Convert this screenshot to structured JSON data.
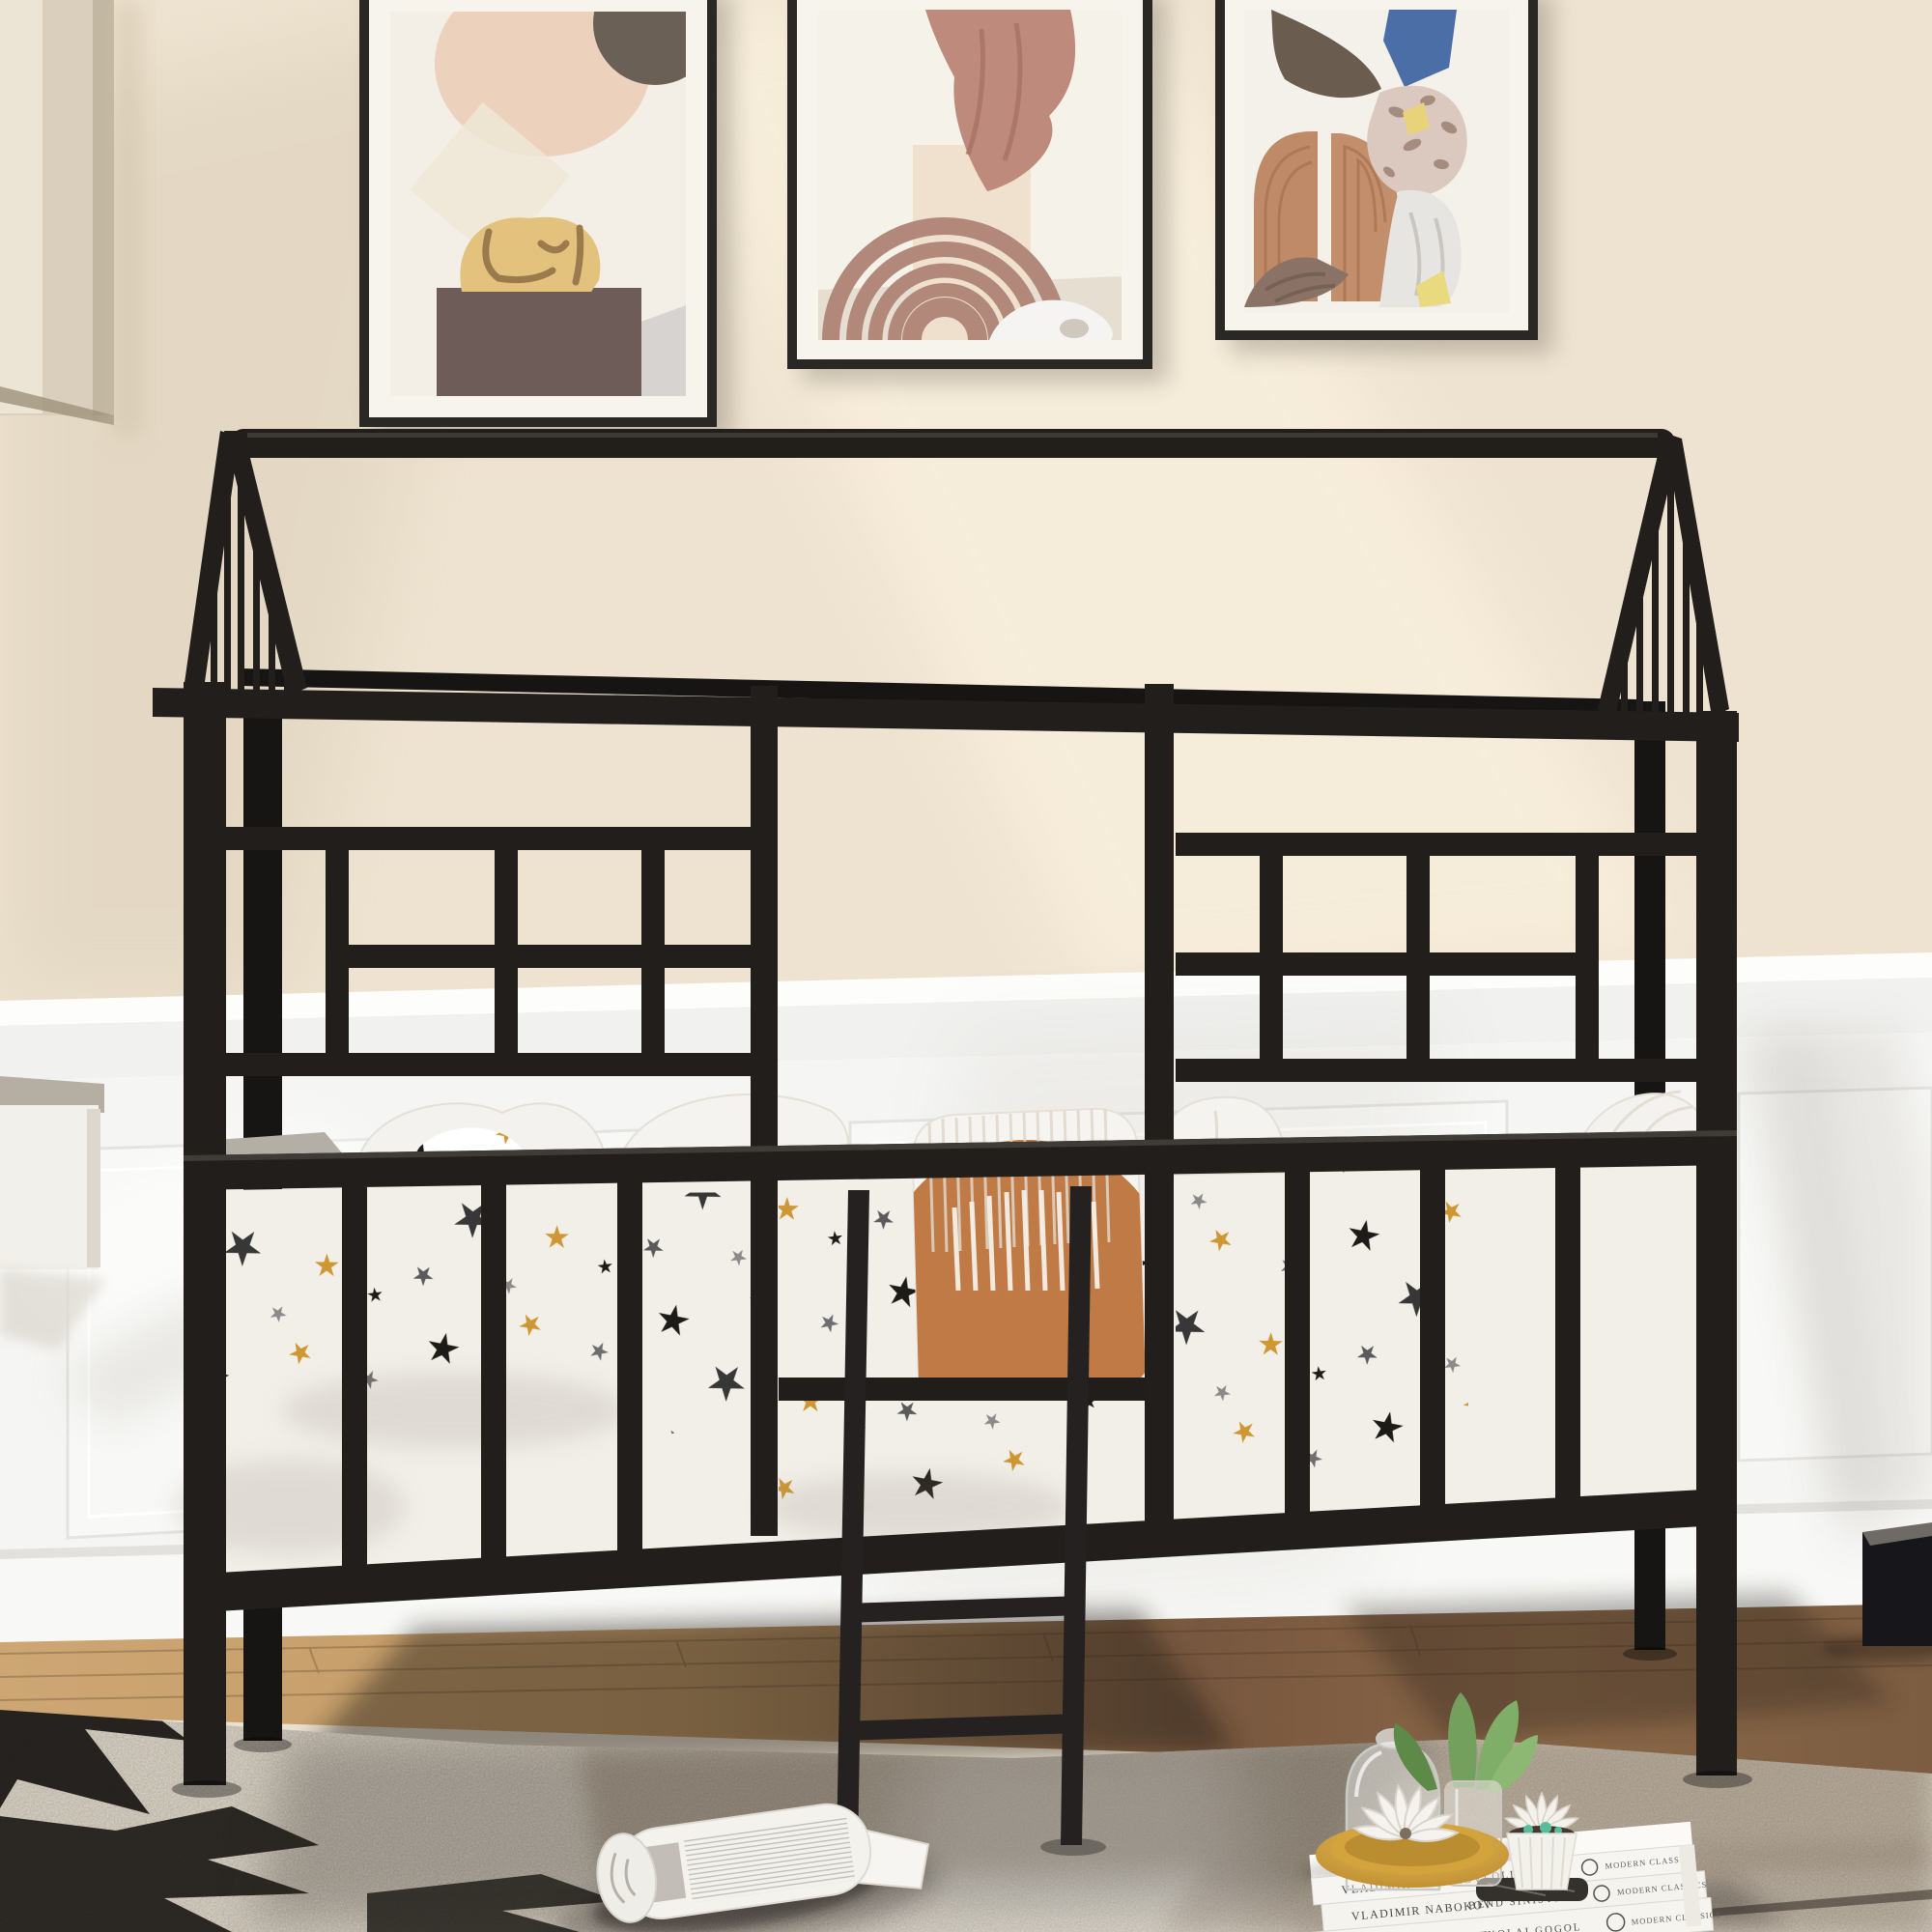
{
  "scene": {
    "description": "Product lifestyle photo: black metal house-frame kids bed with star-print bedding and ladder, beige wall with white wainscoting, three abstract art prints, woven rug with decor objects",
    "camera": "straight-on interior view"
  },
  "colors": {
    "wall_beige": "#eee3d0",
    "wainscot_white": "#f5f5f3",
    "bed_frame_black": "#211e1c",
    "bed_frame_back": "#171513",
    "accent_terracotta": "#bf7a45",
    "bedding_white": "#f2efe9",
    "rug_base": "#d6cfc2",
    "wood_floor": "#c09468",
    "gold_bowl": "#d3a33c",
    "plant_green": "#74a05e",
    "star_black": "#1d1b18",
    "star_gold": "#cf9733"
  },
  "books": [
    {
      "author": "VLADIMIR NABOKOV",
      "title": "LOLITA",
      "publisher": "MODERN CLASSICS"
    },
    {
      "author": "VLADIMIR NABOKOV",
      "title": "BEND SINISTER",
      "publisher": "MODERN CLASSICS"
    },
    {
      "author": "VLADIMIR NABOKOV",
      "title": "NIKOLAI GOGOL",
      "publisher": "MODERN CLASSICS"
    }
  ],
  "artwork_frames": [
    {
      "position": "left",
      "subject": "abstract collage, yellow stone on plinth"
    },
    {
      "position": "middle",
      "subject": "abstract arch with rose drape"
    },
    {
      "position": "right",
      "subject": "abstract split terracotta arch"
    }
  ],
  "objects": [
    "house-shaped metal bed frame",
    "metal ladder",
    "star print quilt",
    "terracotta lumbar pillow",
    "white pillows",
    "woven area rug",
    "rolled magazine",
    "stack of three books",
    "gold bowl with ceramic succulent",
    "glass cloche",
    "glass vase with green succulent",
    "white ribbed planter",
    "black side box",
    "wall cabinet corner",
    "white wall shelf"
  ]
}
